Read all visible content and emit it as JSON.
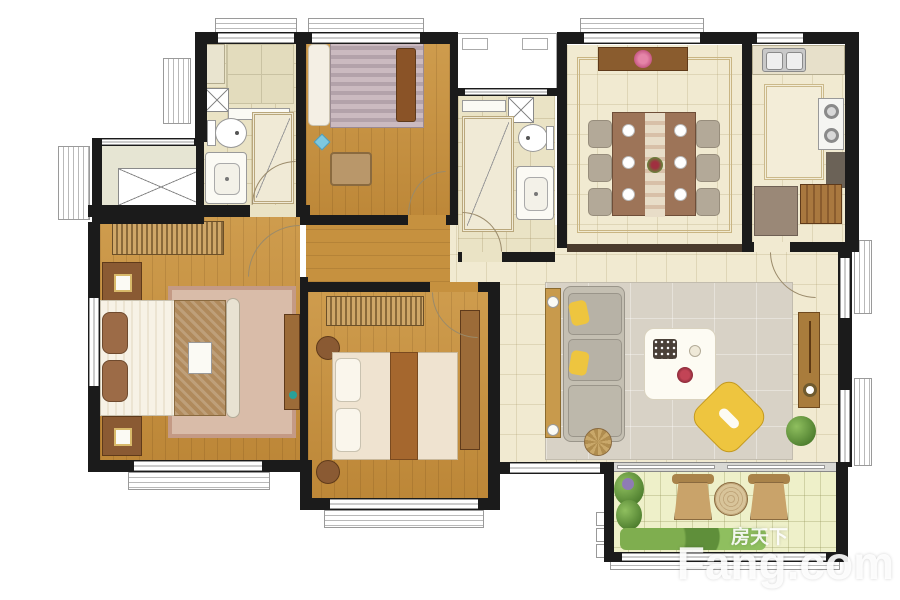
{
  "watermark": {
    "site_name_cn": "房天下",
    "site_name_en": "Fang.com"
  },
  "palette": {
    "wall": "#1b1b1b",
    "wall-soft": "#4a3b2d",
    "wood": "#c6913f",
    "tile": "#f1ead1",
    "tile-bath": "#eae3c5",
    "tile-balcony": "#eef0c9",
    "rug-living": "#d8d2c6",
    "rug-master": "#d9bca9",
    "accent-yellow": "#eec53f",
    "plant-green": "#6f9b3f",
    "fixture": "#fbfaf4",
    "counter": "#6b6257",
    "furniture-wood": "#9c6b38",
    "fabric-gray": "#b3a998",
    "watermark": "rgba(255,255,255,0.9)"
  }
}
